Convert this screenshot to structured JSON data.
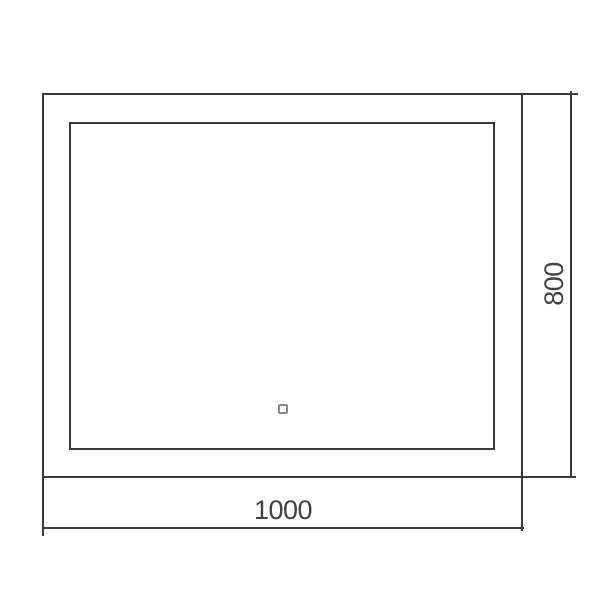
{
  "drawing": {
    "kind": "technical-dimension-drawing",
    "dimensions": {
      "width": {
        "label": "1000"
      },
      "height": {
        "label": "800"
      }
    },
    "icons": {
      "touch_sensor": "touch-sensor-square-outline"
    },
    "colors": {
      "background": "#ffffff",
      "line": "#3a3a3c",
      "text": "#414143",
      "sensor_outline": "#8a8a8a"
    }
  }
}
